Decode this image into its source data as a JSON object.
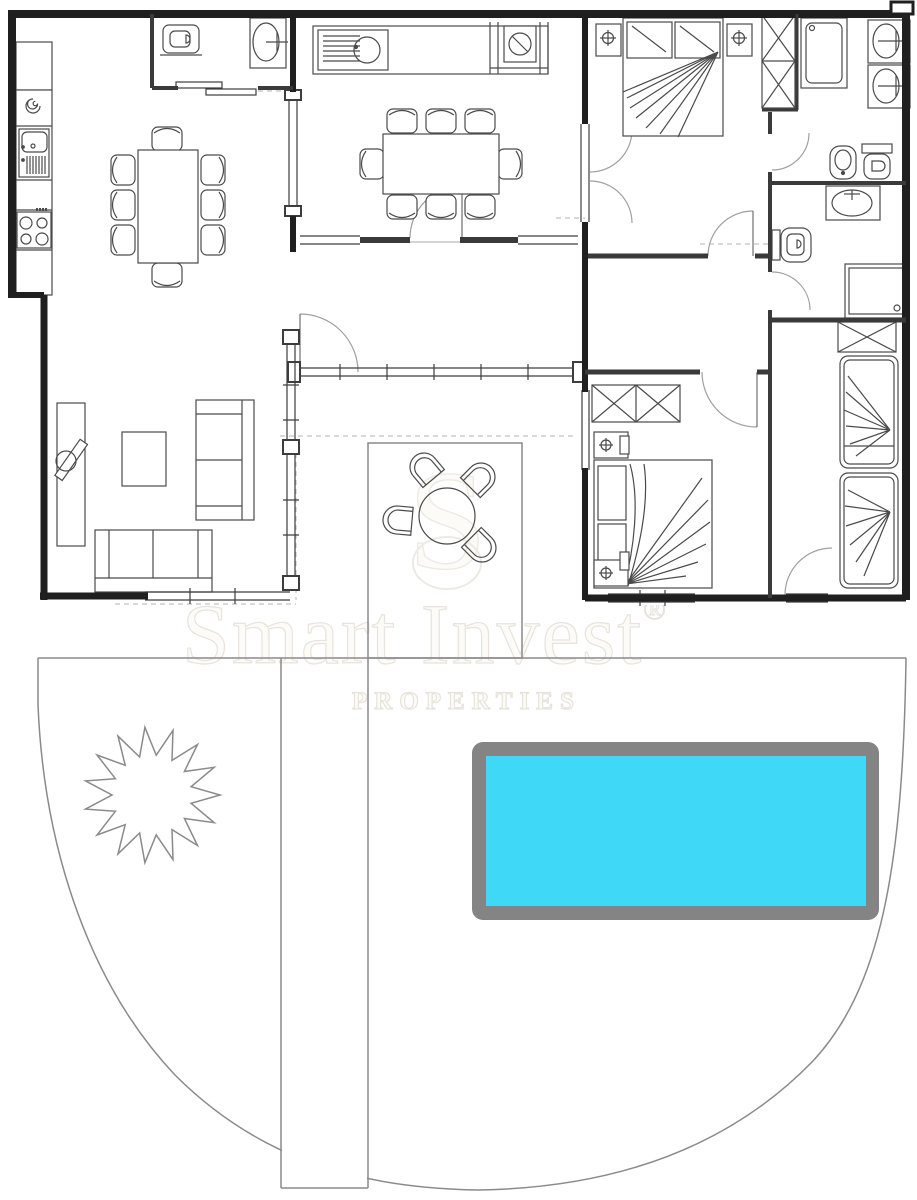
{
  "watermark": {
    "brand": "Smart Invest",
    "registered": "®",
    "tagline": "PROPERTIES",
    "monogram": "S"
  },
  "palette": {
    "paper": "#ffffff",
    "wall": "#1f1f1f",
    "partition": "#3a3a3a",
    "fixture": "#4a4a4a",
    "door_arc": "#a0a0a0",
    "door_leaf": "#6f6f6f",
    "site_line": "#8a8a8a",
    "dashed": "#c2c2c2",
    "window_line": "#3d3d3d",
    "pool_water": "#3fd9f7",
    "pool_deck": "#848484",
    "watermark_fill": "#fcfbf7",
    "watermark_stroke": "#e7e4dd"
  },
  "symbols": {
    "kitchen_left": [
      "upper-cabinet",
      "extractor-spiral",
      "sink-with-drainer",
      "cooktop-4-burners"
    ],
    "wc": [
      "toilet",
      "wash-basin",
      "sliding-door"
    ],
    "dining_room_left": [
      "dining-table",
      "8-chairs"
    ],
    "dining_room_middle": [
      "counter-sink",
      "stove",
      "dining-table",
      "8-chairs"
    ],
    "master_bedroom": [
      "double-bed",
      "2-nightstands",
      "2-lamps",
      "wardrobe"
    ],
    "bathroom_top": [
      "shower",
      "double-vanity",
      "bidet",
      "toilet"
    ],
    "bathroom_middle": [
      "vanity",
      "toilet",
      "shower"
    ],
    "bedroom_2": [
      "wardrobe",
      "double-bed",
      "2-nightstands",
      "2-lamps"
    ],
    "kids_room": [
      "wardrobe",
      "single-bed",
      "single-bed"
    ],
    "living_room": [
      "tv-cabinet",
      "tv",
      "coffee-table",
      "sofa",
      "sofa"
    ],
    "patio": [
      "round-table",
      "4-chairs"
    ],
    "garden": [
      "tree",
      "walkway",
      "swimming-pool",
      "garden-boundary"
    ]
  }
}
